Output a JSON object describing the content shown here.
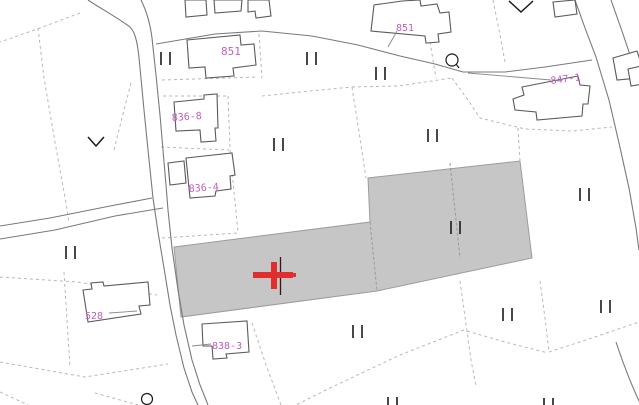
{
  "map": {
    "type": "cadastral-parcel-map",
    "background_color": "#ffffff",
    "colors": {
      "parcel_label": "#c05fc0",
      "highlight_parcel_fill": "#c6c6c6",
      "road_line": "#7a7a7a",
      "building_outline": "#5a5a5a",
      "boundary_dashed": "#b8b8b8",
      "marker_red": "#e02e2e",
      "symbol_black": "#1a1a1a"
    },
    "labels": [
      {
        "text": "851"
      },
      {
        "text": "851"
      },
      {
        "text": "847-1"
      },
      {
        "text": "836-8"
      },
      {
        "text": "836-4"
      },
      {
        "text": "838-3"
      },
      {
        "text": "528"
      }
    ],
    "selection_marker": {
      "type": "red-cross",
      "x": 274,
      "y": 275
    },
    "highlighted_parcels": {
      "count": 3,
      "fill": "#c6c6c6"
    },
    "field_symbols": {
      "glyph": "||",
      "positions": [
        [
          165,
          58
        ],
        [
          311,
          58
        ],
        [
          380,
          73
        ],
        [
          278,
          144
        ],
        [
          432,
          135
        ],
        [
          584,
          194
        ],
        [
          455,
          227
        ],
        [
          70,
          252
        ],
        [
          357,
          331
        ],
        [
          507,
          314
        ],
        [
          605,
          306
        ],
        [
          392,
          403
        ],
        [
          548,
          403
        ]
      ]
    },
    "circle_symbols": [
      [
        452,
        60
      ],
      [
        147,
        399
      ]
    ],
    "chevron_symbols": [
      [
        96,
        142
      ],
      [
        521,
        7
      ]
    ]
  }
}
